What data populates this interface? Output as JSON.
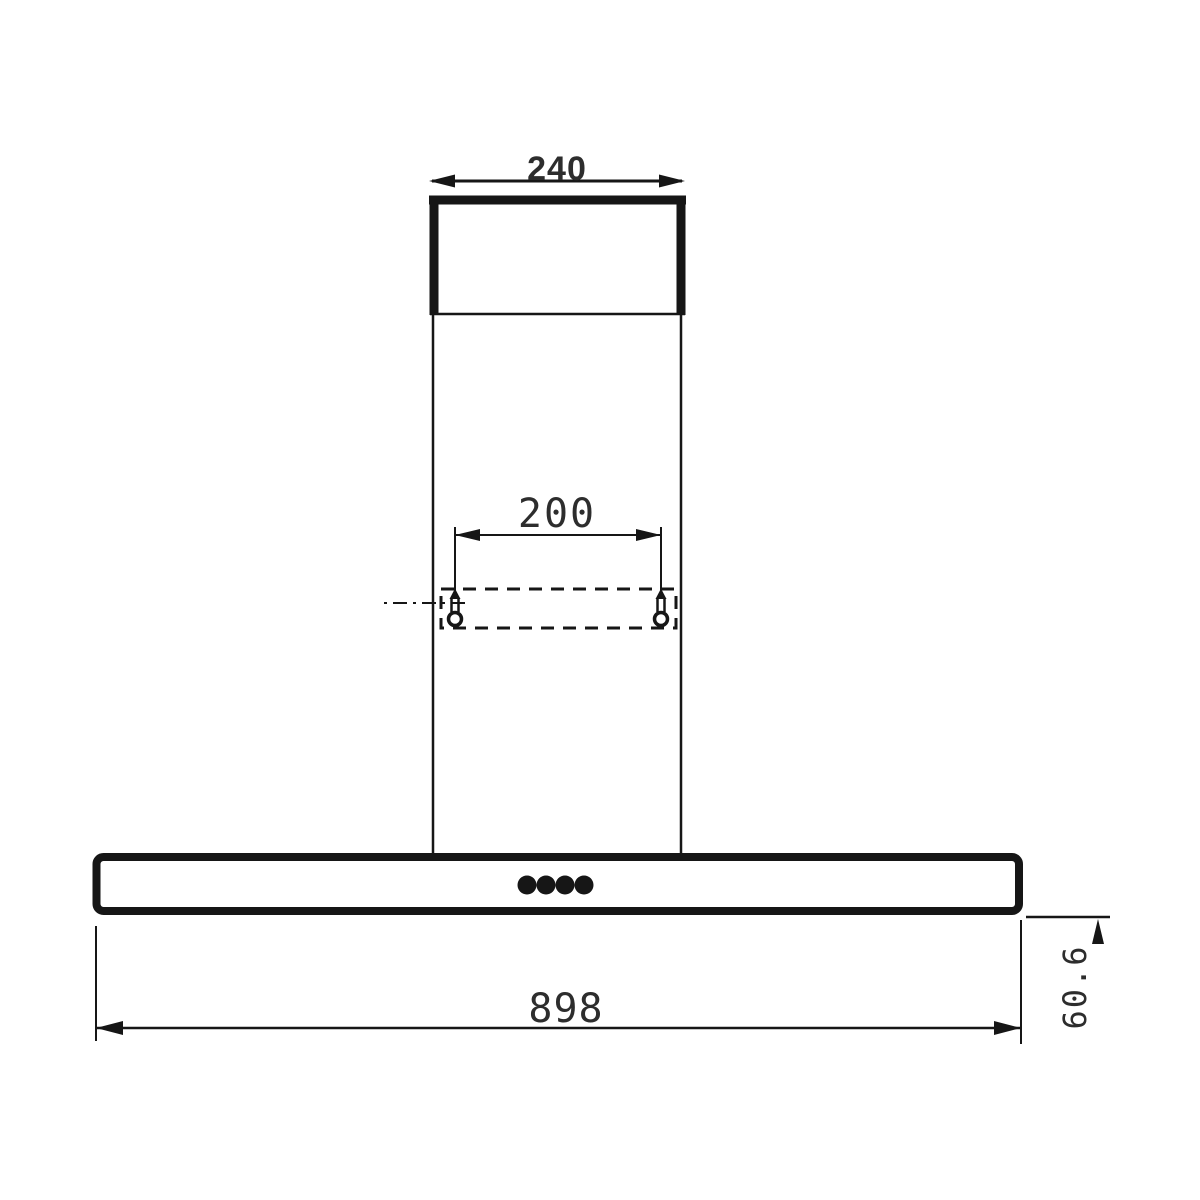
{
  "drawing": {
    "title": "Chimney cooker hood front-view dimension drawing",
    "background": "#ffffff",
    "line_color": "#161616",
    "text_color": "#2d2d2d",
    "dimensions": {
      "duct_width": "240",
      "mounting_hole_spacing": "200",
      "hood_width": "898",
      "hood_body_height": "60.6"
    }
  }
}
